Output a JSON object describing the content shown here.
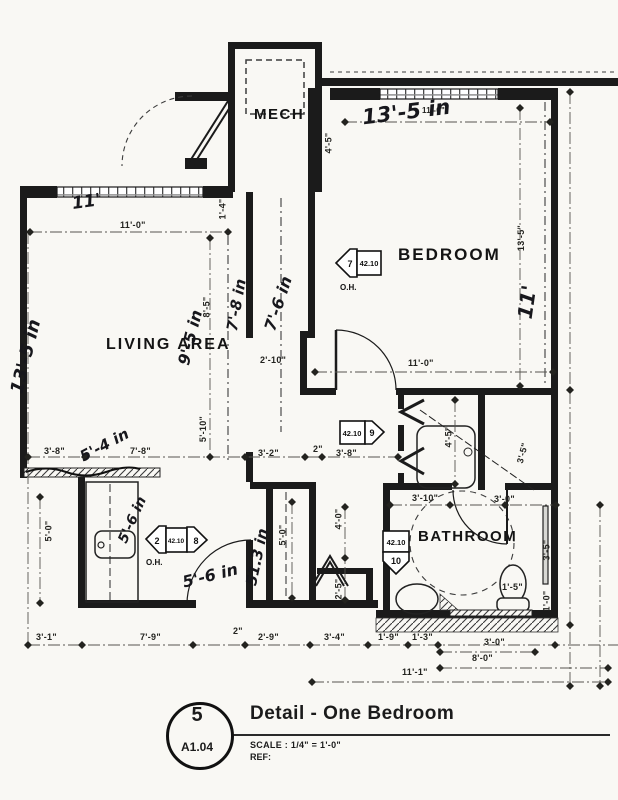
{
  "title_block": {
    "detail_number": "5",
    "sheet_number": "A1.04",
    "title": "Detail - One Bedroom",
    "scale_label": "SCALE : 1/4\" = 1'-0\"",
    "ref_label": "REF:"
  },
  "room_labels": {
    "mech": "MECH",
    "bedroom": "BEDROOM",
    "living_area": "LIVING AREA",
    "bathroom": "BATHROOM"
  },
  "keynote_tags": {
    "bedroom_head": {
      "arrow_number": "7",
      "keynote": "42.10",
      "note": "O.H."
    },
    "hall_head": {
      "keynote": "42.10",
      "arrow_number": "9"
    },
    "living_head": {
      "arrow_number_left": "2",
      "keynote": "42.10",
      "arrow_number_right": "8",
      "note": "O.H."
    },
    "bath_floor": {
      "keynote": "42.10",
      "arrow_number": "10"
    }
  },
  "printed_dimensions": [
    "11'-0\"",
    "4'-5\"",
    "13'-5\"",
    "11'-0\"",
    "1'-4\"",
    "8'-5\"",
    "2'-10\"",
    "11'-0\"",
    "3'-8\"",
    "7'-8\"",
    "3'-2\"",
    "2\"",
    "3'-8\"",
    "4'-5\"",
    "3'-5\"",
    "5'-10\"",
    "3'-10\"",
    "3'-0\"",
    "3'-5\"",
    "1'-0\"",
    "1'-5\"",
    "4'-0\"",
    "5'-0\"",
    "2'-5\"",
    "5'-0\"",
    "3'-1\"",
    "7'-9\"",
    "2\"",
    "2'-9\"",
    "3'-4\"",
    "1'-9\"",
    "1'-3\"",
    "3'-0\"",
    "8'-0\"",
    "11'-1\""
  ],
  "handwritten_dimensions": [
    "11'",
    "13'-5 in",
    "13'-5 in",
    "9'-5 in",
    "7'-8 in",
    "7'-6 in",
    "5'-4 in",
    "5'-6 in",
    "5'-6 in",
    "51.3 in",
    "11'"
  ]
}
